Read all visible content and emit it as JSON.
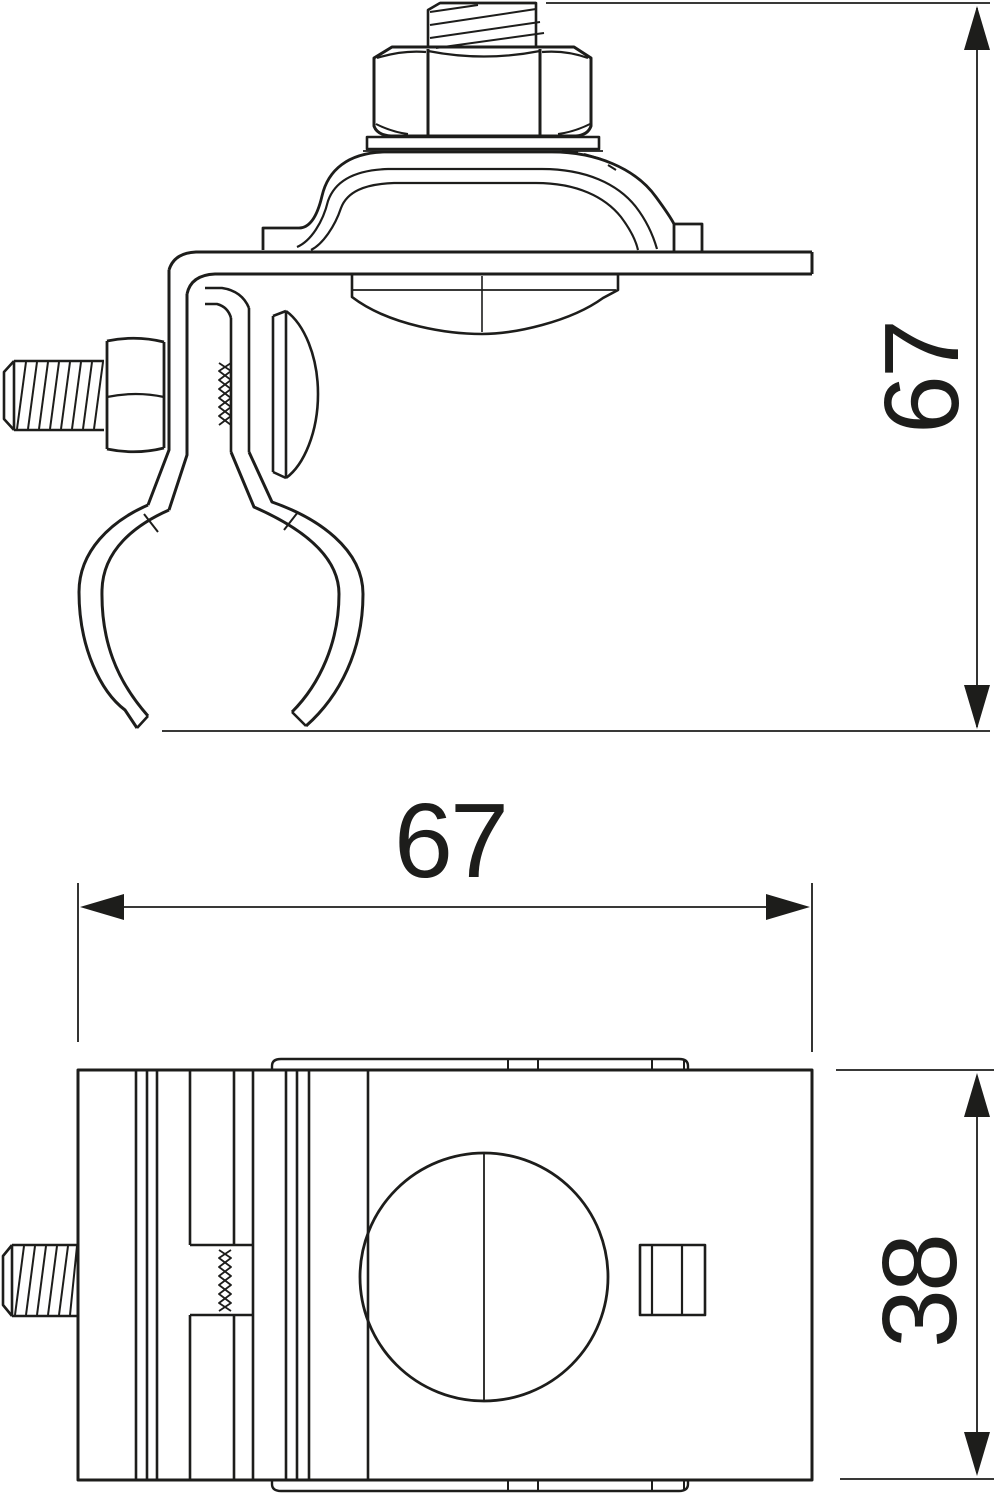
{
  "drawing": {
    "type": "technical-drawing",
    "description": "Two orthographic views of a pipe/earthing clamp with saddle conductor holder",
    "views": [
      "side-view",
      "front-view"
    ]
  },
  "dimensions": {
    "side_height": {
      "value": "67",
      "orientation": "vertical",
      "view": "side-view"
    },
    "front_width": {
      "value": "67",
      "orientation": "horizontal",
      "view": "front-view"
    },
    "front_height": {
      "value": "38",
      "orientation": "vertical",
      "view": "front-view"
    }
  },
  "colors": {
    "line": "#1d1d1b",
    "background": "#ffffff"
  },
  "icons": {
    "arrow_up": "filled triangle arrowhead pointing up",
    "arrow_down": "filled triangle arrowhead pointing down",
    "arrow_left": "filled triangle arrowhead pointing left",
    "arrow_right": "filled triangle arrowhead pointing right"
  }
}
